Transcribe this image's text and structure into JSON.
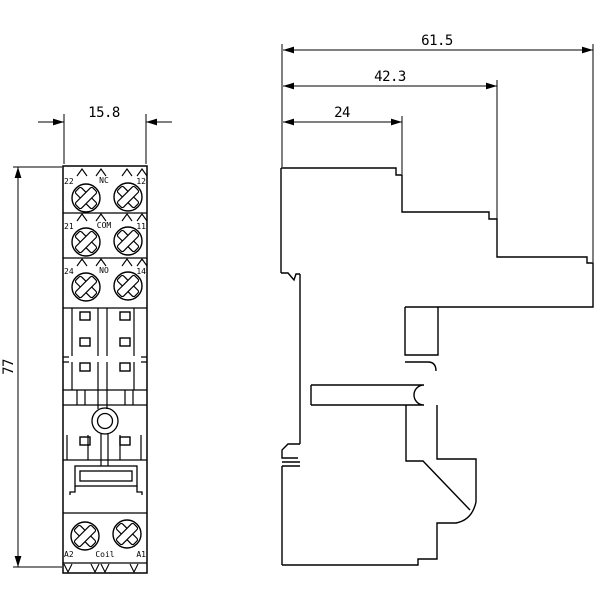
{
  "drawing": {
    "front_view": {
      "width_label": "15.8",
      "height_label": "77",
      "terminal_rows": [
        {
          "left": "22",
          "center": "NC",
          "right": "12"
        },
        {
          "left": "21",
          "center": "COM",
          "right": "11"
        },
        {
          "left": "24",
          "center": "NO",
          "right": "14"
        }
      ],
      "coil_row": {
        "left": "A2",
        "center": "Coil",
        "right": "A1"
      }
    },
    "side_view": {
      "overall_depth_label": "61.5",
      "body_depth_label": "42.3",
      "front_depth_label": "24"
    },
    "colors": {
      "line": "#000000",
      "background": "#ffffff"
    }
  }
}
